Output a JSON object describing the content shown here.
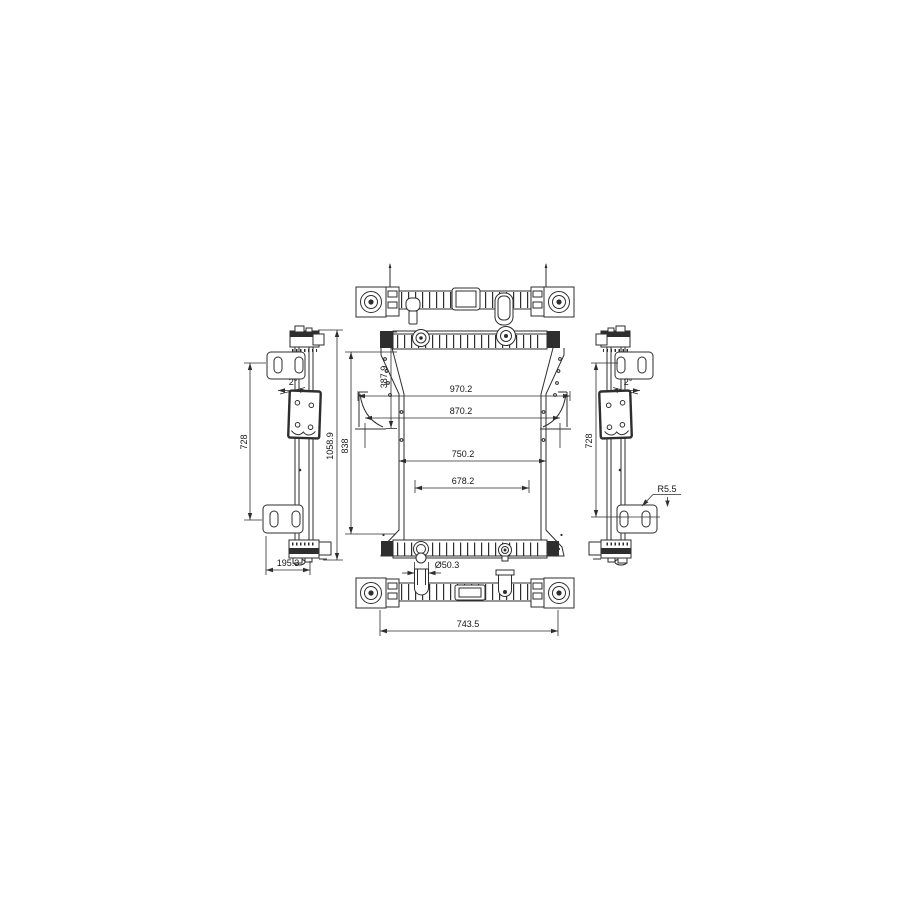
{
  "meta": {
    "background_color": "#ffffff",
    "line_color": "#2e2e2e",
    "text_color": "#141414"
  },
  "dimensions": {
    "overall_width": "970.2",
    "mounting_width": "870.2",
    "core_width": "750.2",
    "inner_core_width": "678.2",
    "top_to_flange_height": "387.9",
    "overall_height": "1058.9",
    "core_height": "838",
    "bracket_span_left": "728",
    "bracket_span_right": "728",
    "side_depth": "195.3",
    "outlet_pipe_diameter": "Ø50.3",
    "bottom_mount_width": "743.5",
    "bracket_corner_radius": "R5.5",
    "tilt_angle_left": "2°",
    "tilt_angle_right": "2°"
  }
}
